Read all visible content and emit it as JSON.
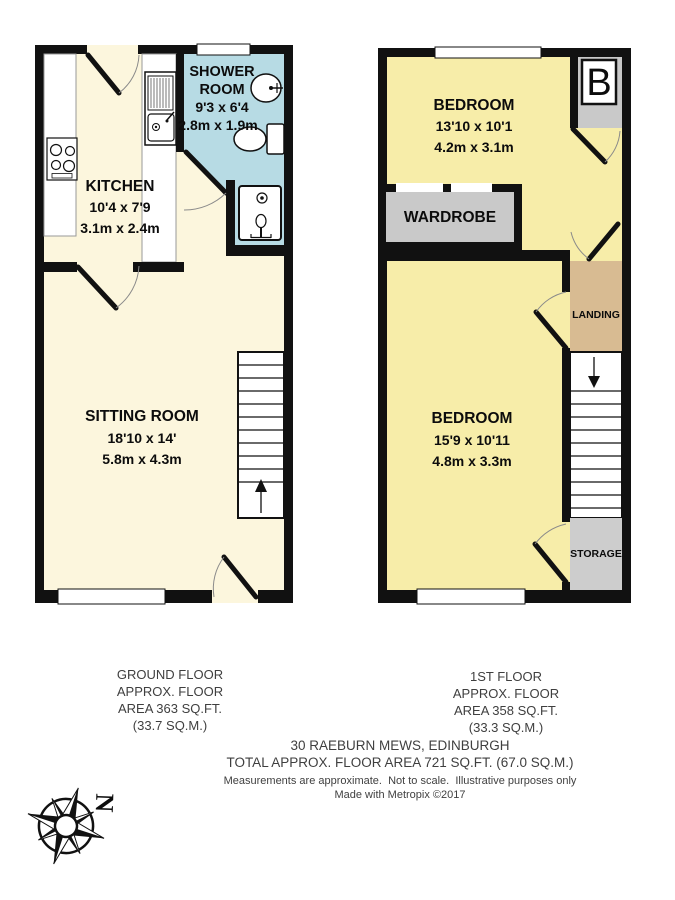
{
  "ground_floor": {
    "floor_label": [
      "GROUND FLOOR",
      "APPROX. FLOOR",
      "AREA 363 SQ.FT.",
      "(33.7 SQ.M.)"
    ],
    "rooms": {
      "kitchen": {
        "name": "KITCHEN",
        "size_imperial": "10'4 x 7'9",
        "size_metric": "3.1m x 2.4m"
      },
      "shower_room": {
        "name_line1": "SHOWER",
        "name_line2": "ROOM",
        "size_imperial": "9'3 x 6'4",
        "size_metric": "2.8m x 1.9m"
      },
      "sitting_room": {
        "name": "SITTING ROOM",
        "size_imperial": "18'10 x 14'",
        "size_metric": "5.8m x 4.3m"
      }
    }
  },
  "first_floor": {
    "floor_label": [
      "1ST FLOOR",
      "APPROX. FLOOR",
      "AREA 358 SQ.FT.",
      "(33.3 SQ.M.)"
    ],
    "rooms": {
      "bedroom_front": {
        "name": "BEDROOM",
        "size_imperial": "13'10 x 10'1",
        "size_metric": "4.2m x 3.1m"
      },
      "bedroom_back": {
        "name": "BEDROOM",
        "size_imperial": "15'9 x 10'11",
        "size_metric": "4.8m x 3.3m"
      },
      "wardrobe": {
        "name": "WARDROBE"
      },
      "landing": {
        "name": "LANDING"
      },
      "storage": {
        "name": "STORAGE"
      },
      "boiler": {
        "label": "B"
      }
    }
  },
  "footer": {
    "address": "30 RAEBURN MEWS, EDINBURGH",
    "total_area": "TOTAL APPROX. FLOOR AREA 721 SQ.FT. (67.0 SQ.M.)",
    "disclaimer": "Measurements are approximate.  Not to scale.  Illustrative purposes only",
    "credit": "Made with Metropix ©2017"
  },
  "compass": {
    "north": "N"
  },
  "colors": {
    "wall": "#111111",
    "ground_floor_fill": "#FCF6DD",
    "first_floor_fill": "#F7EDA9",
    "shower_room_fill": "#B7DBE4",
    "landing_fill": "#D8BB92",
    "storage_fill": "#CDCDCD",
    "wardrobe_fill": "#C9C9C9"
  }
}
